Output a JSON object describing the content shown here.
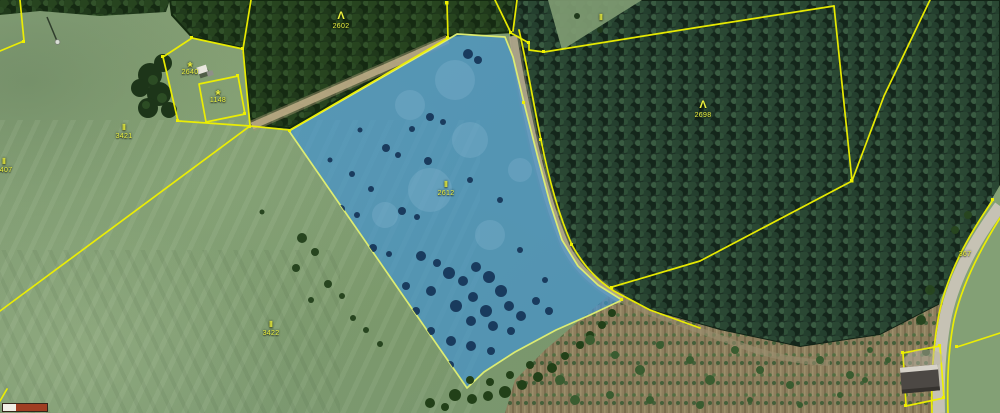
{
  "map": {
    "description_labels": {
      "selected_parcel_symbol": "Ⅱ",
      "selected_parcel_number": "2612"
    },
    "colors": {
      "boundary_yellow": "#eef000",
      "selection_fill": "#3f93d6",
      "selection_stroke": "#dcec72",
      "label_yellow": "#edf23f"
    },
    "annotations": [
      {
        "name": "forest-parcel-label",
        "type": "forest",
        "symbol": "Λ",
        "number": "2602",
        "x": 341,
        "y": 11
      },
      {
        "name": "forest-parcel-label",
        "type": "forest",
        "symbol": "Λ",
        "number": "2698",
        "x": 703,
        "y": 100
      },
      {
        "name": "selected-parcel-label",
        "type": "grass",
        "symbol": "Ⅱ",
        "number": "2612",
        "x": 446,
        "y": 181
      },
      {
        "name": "grass-parcel-label",
        "type": "grass",
        "symbol": "Ⅱ",
        "number": "3421",
        "x": 124,
        "y": 124
      },
      {
        "name": "grass-parcel-label",
        "type": "grass",
        "symbol": "Ⅱ",
        "number": "3407",
        "x": 4,
        "y": 158
      },
      {
        "name": "grass-parcel-label",
        "type": "grass",
        "symbol": "Ⅱ",
        "number": "3422",
        "x": 271,
        "y": 321
      },
      {
        "name": "garden-parcel-label",
        "type": "garden",
        "symbol": "*",
        "number": "2640",
        "x": 190,
        "y": 60
      },
      {
        "name": "garden-parcel-label",
        "type": "garden",
        "symbol": "*",
        "number": "1148",
        "x": 218,
        "y": 88
      },
      {
        "name": "road-parcel-label",
        "type": "road",
        "symbol": "",
        "number": "367",
        "x": 965,
        "y": 250
      },
      {
        "name": "grass-symbol-label",
        "type": "grass",
        "symbol": "Ⅱ",
        "number": "",
        "x": 601,
        "y": 14
      }
    ]
  },
  "scalebar": {
    "x": 2,
    "y": 403,
    "height": 7,
    "border_color": "#33251a",
    "segments": [
      {
        "color": "#f2efe6",
        "width": 13
      },
      {
        "color": "#a03e22",
        "width": 31
      }
    ]
  }
}
